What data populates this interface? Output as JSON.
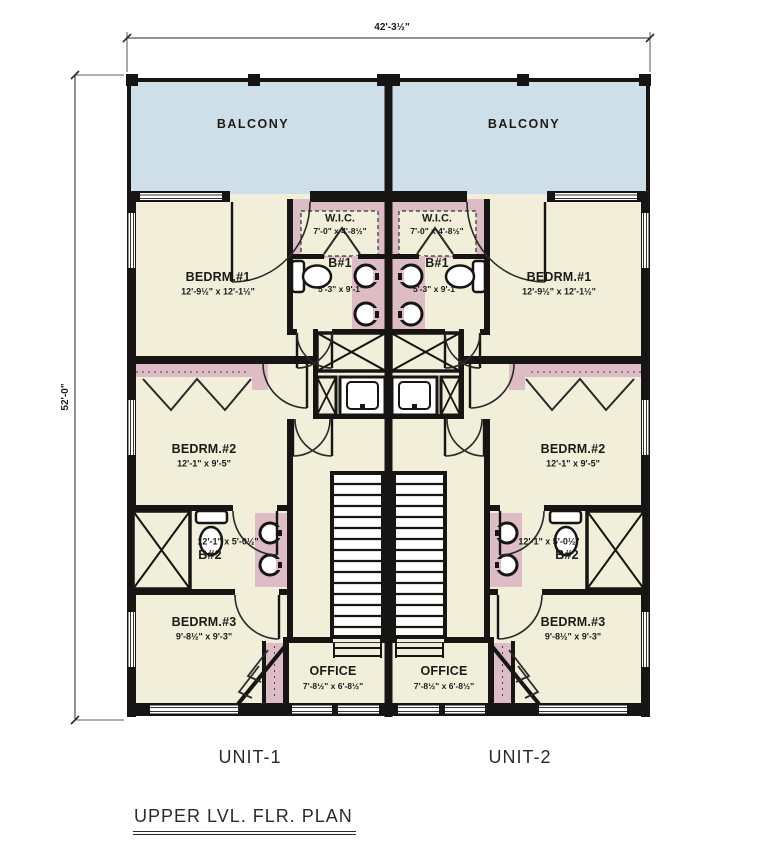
{
  "drawing_title": "UPPER LVL. FLR. PLAN",
  "dimensions": {
    "overall_width": "42'-3½\"",
    "overall_height": "52'-0\""
  },
  "units": [
    {
      "name": "UNIT-1"
    },
    {
      "name": "UNIT-2"
    }
  ],
  "rooms": {
    "balcony": {
      "label": "BALCONY"
    },
    "bedrm1": {
      "label": "BEDRM.#1",
      "dims": "12'-9½\" x 12'-1½\""
    },
    "wic": {
      "label": "W.I.C.",
      "dims": "7'-0\" x 4'-8½\""
    },
    "b1": {
      "label": "B#1",
      "dims": "5'-3\" x 9'-1\""
    },
    "bedrm2": {
      "label": "BEDRM.#2",
      "dims": "12'-1\" x 9'-5\""
    },
    "b2": {
      "label": "B#2",
      "dims": "12'-1\" x 5'-0½\""
    },
    "bedrm3": {
      "label": "BEDRM.#3",
      "dims": "9'-8½\" x 9'-3\""
    },
    "office": {
      "label": "OFFICE",
      "dims": "7'-8½\" x 6'-8½\""
    }
  },
  "colors": {
    "floor": "#f1eeda",
    "balcony": "#cfdfe9",
    "pink": "#ddbcc6",
    "wall": "#161513",
    "line": "#333330"
  }
}
